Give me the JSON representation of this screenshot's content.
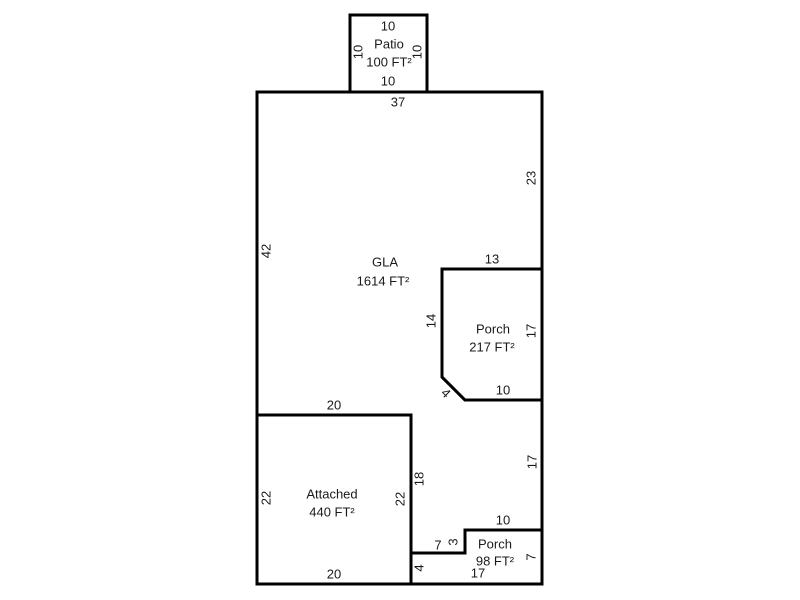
{
  "colors": {
    "background": "#ffffff",
    "wall_line": "#000000",
    "label_text": "#1a1a1a"
  },
  "floorplan": {
    "areas": [
      {
        "id": "patio",
        "name": "Patio",
        "area_label": "100 FT²",
        "area_sqft": 100,
        "dims": [
          "10",
          "10",
          "10",
          "10"
        ]
      },
      {
        "id": "gla",
        "name": "GLA",
        "area_label": "1614 FT²",
        "area_sqft": 1614,
        "dims": [
          "37",
          "42",
          "23",
          "13",
          "14",
          "4",
          "10",
          "17",
          "10",
          "3",
          "7",
          "18",
          "20"
        ]
      },
      {
        "id": "porch-upper",
        "name": "Porch",
        "area_label": "217 FT²",
        "area_sqft": 217,
        "dims": [
          "13",
          "14",
          "17",
          "10",
          "4"
        ]
      },
      {
        "id": "garage",
        "name": "Attached",
        "area_label": "440 FT²",
        "area_sqft": 440,
        "dims": [
          "20",
          "22",
          "22",
          "20",
          "18"
        ]
      },
      {
        "id": "porch-lower",
        "name": "Porch",
        "area_label": "98 FT²",
        "area_sqft": 98,
        "dims": [
          "10",
          "3",
          "7",
          "4",
          "17",
          "7"
        ]
      }
    ],
    "labels": [
      {
        "name": "patio-dim-top",
        "text": "10",
        "x": 388,
        "y": 26,
        "rot": 0
      },
      {
        "name": "patio-name-label",
        "text": "Patio",
        "x": 389,
        "y": 44,
        "rot": 0
      },
      {
        "name": "patio-area-label",
        "text": "100 FT²",
        "x": 389,
        "y": 62,
        "rot": 0
      },
      {
        "name": "patio-dim-left",
        "text": "10",
        "x": 358,
        "y": 52,
        "rot": -90
      },
      {
        "name": "patio-dim-right",
        "text": "10",
        "x": 417,
        "y": 52,
        "rot": -90
      },
      {
        "name": "patio-dim-bottom",
        "text": "10",
        "x": 388,
        "y": 81,
        "rot": 0
      },
      {
        "name": "gla-dim-top",
        "text": "37",
        "x": 398,
        "y": 102,
        "rot": 0
      },
      {
        "name": "gla-dim-left",
        "text": "42",
        "x": 266,
        "y": 251,
        "rot": -90
      },
      {
        "name": "gla-dim-right",
        "text": "23",
        "x": 531,
        "y": 178,
        "rot": -90
      },
      {
        "name": "gla-name-label",
        "text": "GLA",
        "x": 385,
        "y": 262,
        "rot": 0
      },
      {
        "name": "gla-area-label",
        "text": "1614 FT²",
        "x": 383,
        "y": 281,
        "rot": 0
      },
      {
        "name": "upper-porch-dim-top",
        "text": "13",
        "x": 492,
        "y": 259,
        "rot": 0
      },
      {
        "name": "upper-porch-dim-left",
        "text": "14",
        "x": 431,
        "y": 321,
        "rot": -90
      },
      {
        "name": "upper-porch-name-label",
        "text": "Porch",
        "x": 493,
        "y": 329,
        "rot": 0
      },
      {
        "name": "upper-porch-area-label",
        "text": "217 FT²",
        "x": 492,
        "y": 347,
        "rot": 0
      },
      {
        "name": "upper-porch-dim-right",
        "text": "17",
        "x": 531,
        "y": 331,
        "rot": -90
      },
      {
        "name": "upper-porch-dim-diag",
        "text": "4",
        "x": 446,
        "y": 393,
        "rot": 45
      },
      {
        "name": "upper-porch-dim-bottom",
        "text": "10",
        "x": 503,
        "y": 390,
        "rot": 0
      },
      {
        "name": "gla-strip-dim-right",
        "text": "17",
        "x": 532,
        "y": 462,
        "rot": -90
      },
      {
        "name": "lower-porch-dim-top",
        "text": "10",
        "x": 503,
        "y": 520,
        "rot": 0
      },
      {
        "name": "lower-porch-name-label",
        "text": "Porch",
        "x": 495,
        "y": 544,
        "rot": 0
      },
      {
        "name": "lower-porch-area-label",
        "text": "98 FT²",
        "x": 495,
        "y": 561,
        "rot": 0
      },
      {
        "name": "gla-step-dim-h",
        "text": "7",
        "x": 438,
        "y": 545,
        "rot": 0
      },
      {
        "name": "gla-step-dim-v",
        "text": "3",
        "x": 453,
        "y": 542,
        "rot": -90
      },
      {
        "name": "lower-porch-dim-right",
        "text": "7",
        "x": 531,
        "y": 557,
        "rot": -90
      },
      {
        "name": "lower-porch-dim-left",
        "text": "4",
        "x": 419,
        "y": 568,
        "rot": -90
      },
      {
        "name": "lower-porch-dim-bottom",
        "text": "17",
        "x": 478,
        "y": 573,
        "rot": 0
      },
      {
        "name": "garage-dim-top",
        "text": "20",
        "x": 334,
        "y": 405,
        "rot": 0
      },
      {
        "name": "garage-name-label",
        "text": "Attached",
        "x": 332,
        "y": 494,
        "rot": 0
      },
      {
        "name": "garage-area-label",
        "text": "440 FT²",
        "x": 332,
        "y": 512,
        "rot": 0
      },
      {
        "name": "garage-dim-left",
        "text": "22",
        "x": 266,
        "y": 498,
        "rot": -90
      },
      {
        "name": "garage-dim-right",
        "text": "22",
        "x": 400,
        "y": 499,
        "rot": -90
      },
      {
        "name": "gla-dim-garage-side",
        "text": "18",
        "x": 419,
        "y": 479,
        "rot": -90
      },
      {
        "name": "garage-dim-bottom",
        "text": "20",
        "x": 334,
        "y": 574,
        "rot": 0
      }
    ]
  }
}
